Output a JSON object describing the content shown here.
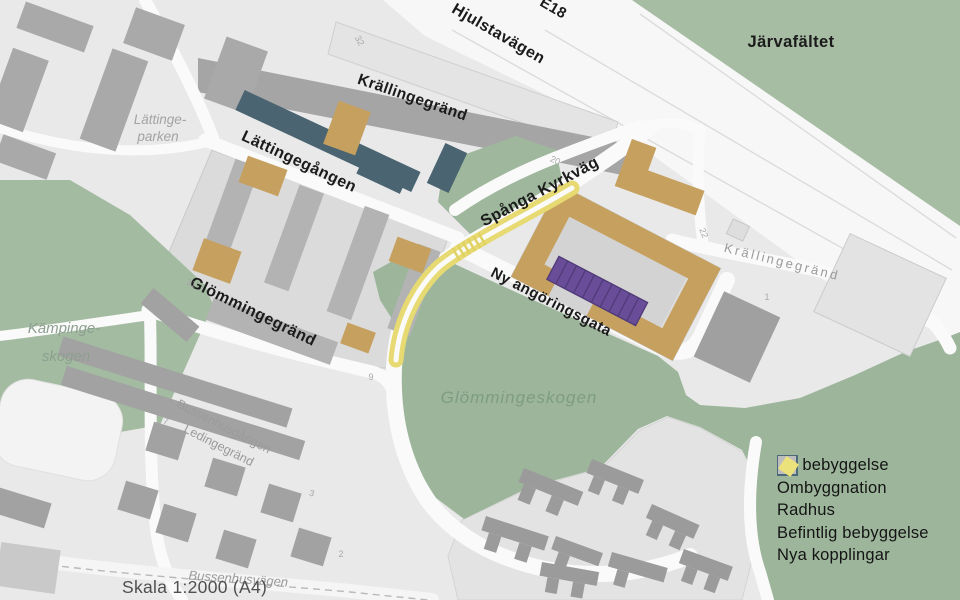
{
  "map_labels": {
    "areas": {
      "jarvafaltet": "Järvafältet",
      "lattingeparken_line1": "Lättinge-",
      "lattingeparken_line2": "parken",
      "kampingeskogen_line1": "Kämpinge-",
      "kampingeskogen_line2": "skogen",
      "glommingeskogen": "Glömmingeskogen"
    },
    "streets": {
      "e18": "E18",
      "hjulstavagen": "Hjulstavägen",
      "krallingegrand_top": "Krällingegränd",
      "lattingegangen": "Lättingegången",
      "spanga_kyrkvag": "Spånga Kyrkväg",
      "ny_angoringsgata": "Ny angöringsgata",
      "glommingegrand": "Glömmingegränd",
      "krallingegrand_right": "Krällingegränd",
      "bussenhusgangen": "Bussenhusgången",
      "ledingegrand": "Ledingegränd",
      "bussenhusvagen": "Bussenhusvägen"
    },
    "house_numbers": {
      "n32": "32",
      "n20": "20",
      "n22": "22",
      "n1": "1",
      "n31": "31",
      "n9": "9",
      "n7": "7",
      "n3": "3",
      "n2": "2"
    }
  },
  "legend": {
    "items": [
      {
        "id": "ny-bebyggelse",
        "label": "Ny bebyggelse",
        "color": "#cfa263",
        "shape": "square"
      },
      {
        "id": "ombyggnation",
        "label": "Ombyggnation",
        "color": "#4d6a7a",
        "shape": "square"
      },
      {
        "id": "radhus",
        "label": "Radhus",
        "color": "#6a4d9b",
        "shape": "square"
      },
      {
        "id": "befintlig-bebyggelse",
        "label": "Befintlig bebyggelse",
        "color": "#bdbdbd",
        "shape": "square"
      },
      {
        "id": "nya-kopplingar",
        "label": "Nya kopplingar",
        "color": "#ece27c",
        "shape": "diamond"
      }
    ]
  },
  "scale_label": "Skala 1:2000 (A4)",
  "palette": {
    "forest_green": "#a1b99e",
    "base_gray": "#e9e9e9",
    "road_white": "#fafafa",
    "road_gray": "#a5a5a5",
    "new_building_tan": "#c6a05f",
    "rebuild_slate": "#4a6471",
    "radhus_purple": "#6a4d99",
    "existing_gray": "#b3b3b3",
    "connection_yellow": "#e7da72",
    "text_black": "#1b1b1b",
    "text_gray": "#9b9b9b"
  }
}
